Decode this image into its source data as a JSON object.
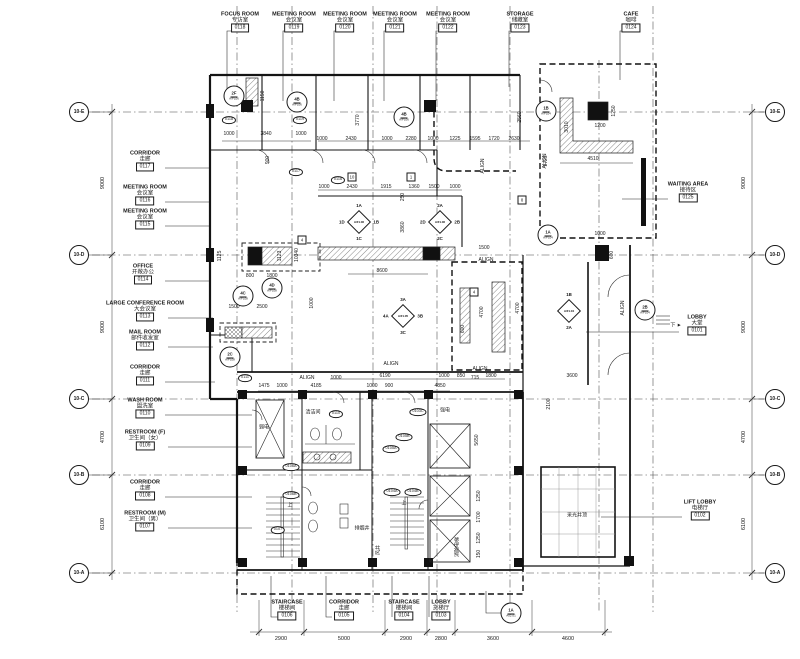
{
  "meta": {
    "background": "#ffffff",
    "ink": "#1a1a1a"
  },
  "rooms": {
    "top": [
      {
        "en": "FOCUS ROOM",
        "cn": "专访室",
        "num": "0118",
        "x": 240,
        "y": 22
      },
      {
        "en": "MEETING ROOM",
        "cn": "会议室",
        "num": "0119",
        "x": 294,
        "y": 22
      },
      {
        "en": "MEETING ROOM",
        "cn": "会议室",
        "num": "0120",
        "x": 345,
        "y": 22
      },
      {
        "en": "MEETING ROOM",
        "cn": "会议室",
        "num": "0121",
        "x": 395,
        "y": 22
      },
      {
        "en": "MEETING ROOM",
        "cn": "会议室",
        "num": "0122",
        "x": 448,
        "y": 22
      },
      {
        "en": "STORAGE",
        "cn": "储藏室",
        "num": "0123",
        "x": 520,
        "y": 22
      },
      {
        "en": "CAFE",
        "cn": "咖啡",
        "num": "0124",
        "x": 631,
        "y": 22
      }
    ],
    "left": [
      {
        "en": "CORRIDOR",
        "cn": "走廊",
        "num": "0117",
        "x": 145,
        "y": 161
      },
      {
        "en": "MEETING ROOM",
        "cn": "会议室",
        "num": "0116",
        "x": 145,
        "y": 195
      },
      {
        "en": "MEETING ROOM",
        "cn": "会议室",
        "num": "0115",
        "x": 145,
        "y": 219
      },
      {
        "en": "OFFICE",
        "cn": "开敞办公",
        "num": "0114",
        "x": 143,
        "y": 274
      },
      {
        "en": "LARGE CONFERENCE ROOM",
        "cn": "大会议室",
        "num": "0113",
        "x": 145,
        "y": 311
      },
      {
        "en": "MAIL ROOM",
        "cn": "邮件收发室",
        "num": "0112",
        "x": 145,
        "y": 340
      },
      {
        "en": "CORRIDOR",
        "cn": "走廊",
        "num": "0111",
        "x": 145,
        "y": 375
      },
      {
        "en": "WASH ROOM",
        "cn": "盥洗室",
        "num": "0110",
        "x": 145,
        "y": 408
      },
      {
        "en": "RESTROOM (F)",
        "cn": "卫生间（女）",
        "num": "0109",
        "x": 145,
        "y": 440
      },
      {
        "en": "CORRIDOR",
        "cn": "走廊",
        "num": "0108",
        "x": 145,
        "y": 490
      },
      {
        "en": "RESTROOM (M)",
        "cn": "卫生间（男）",
        "num": "0107",
        "x": 145,
        "y": 521
      }
    ],
    "right": [
      {
        "en": "WAITING AREA",
        "cn": "接待区",
        "num": "0125",
        "x": 688,
        "y": 192
      },
      {
        "en": "LOBBY",
        "cn": "大堂",
        "num": "0101",
        "x": 697,
        "y": 325
      },
      {
        "en": "LIFT LOBBY",
        "cn": "电梯厅",
        "num": "0102",
        "x": 700,
        "y": 510
      }
    ],
    "bottom": [
      {
        "en": "STAIRCASE",
        "cn": "楼梯间",
        "num": "0106",
        "x": 287,
        "y": 610
      },
      {
        "en": "CORRIDOR",
        "cn": "走廊",
        "num": "0105",
        "x": 344,
        "y": 610
      },
      {
        "en": "STAIRCASE",
        "cn": "楼梯间",
        "num": "0104",
        "x": 404,
        "y": 610
      },
      {
        "en": "LOBBY",
        "cn": "货梯厅",
        "num": "0103",
        "x": 441,
        "y": 610
      }
    ]
  },
  "grid": {
    "left_bubbles": [
      {
        "id": "10-E",
        "x": 79,
        "y": 112
      },
      {
        "id": "10-D",
        "x": 79,
        "y": 255
      },
      {
        "id": "10-C",
        "x": 79,
        "y": 399
      },
      {
        "id": "10-B",
        "x": 79,
        "y": 475
      },
      {
        "id": "10-A",
        "x": 79,
        "y": 573
      }
    ],
    "right_bubbles": [
      {
        "id": "10-E",
        "x": 775,
        "y": 112
      },
      {
        "id": "10-D",
        "x": 775,
        "y": 255
      },
      {
        "id": "10-C",
        "x": 775,
        "y": 399
      },
      {
        "id": "10-B",
        "x": 775,
        "y": 475
      },
      {
        "id": "10-A",
        "x": 775,
        "y": 573
      }
    ],
    "left_dims": [
      {
        "t": "9000",
        "x": 103,
        "y": 183
      },
      {
        "t": "9000",
        "x": 103,
        "y": 327
      },
      {
        "t": "4700",
        "x": 103,
        "y": 437
      },
      {
        "t": "6100",
        "x": 103,
        "y": 524
      }
    ],
    "right_dims": [
      {
        "t": "9000",
        "x": 744,
        "y": 183
      },
      {
        "t": "9000",
        "x": 744,
        "y": 327
      },
      {
        "t": "4700",
        "x": 744,
        "y": 437
      },
      {
        "t": "6100",
        "x": 744,
        "y": 524
      }
    ]
  },
  "bottom_dims": [
    {
      "t": "2900",
      "x": 281
    },
    {
      "t": "5000",
      "x": 344
    },
    {
      "t": "2900",
      "x": 406
    },
    {
      "t": "2800",
      "x": 441
    },
    {
      "t": "3600",
      "x": 493
    },
    {
      "t": "4600",
      "x": 568
    }
  ],
  "annotations": {
    "dims": [
      {
        "t": "1150",
        "x": 263,
        "y": 96,
        "v": 1
      },
      {
        "t": "900",
        "x": 268,
        "y": 160,
        "v": 1
      },
      {
        "t": "3770",
        "x": 358,
        "y": 120,
        "v": 1
      },
      {
        "t": "2560",
        "x": 520,
        "y": 117,
        "v": 1
      },
      {
        "t": "3010",
        "x": 567,
        "y": 127,
        "v": 1
      },
      {
        "t": "1250",
        "x": 614,
        "y": 111,
        "v": 1
      },
      {
        "t": "1725",
        "x": 546,
        "y": 161,
        "v": 1
      },
      {
        "t": "1200",
        "x": 600,
        "y": 126
      },
      {
        "t": "4510",
        "x": 593,
        "y": 159
      },
      {
        "t": "1000",
        "x": 229,
        "y": 134
      },
      {
        "t": "3840",
        "x": 266,
        "y": 134
      },
      {
        "t": "1000",
        "x": 301,
        "y": 134
      },
      {
        "t": "1000",
        "x": 322,
        "y": 139
      },
      {
        "t": "2430",
        "x": 351,
        "y": 139
      },
      {
        "t": "1000",
        "x": 387,
        "y": 139
      },
      {
        "t": "2280",
        "x": 411,
        "y": 139
      },
      {
        "t": "1000",
        "x": 433,
        "y": 139
      },
      {
        "t": "1225",
        "x": 455,
        "y": 139
      },
      {
        "t": "1595",
        "x": 475,
        "y": 139
      },
      {
        "t": "1720",
        "x": 494,
        "y": 139
      },
      {
        "t": "2630",
        "x": 514,
        "y": 139
      },
      {
        "t": "1000",
        "x": 324,
        "y": 187
      },
      {
        "t": "2430",
        "x": 352,
        "y": 187
      },
      {
        "t": "1915",
        "x": 386,
        "y": 187
      },
      {
        "t": "1360",
        "x": 414,
        "y": 187
      },
      {
        "t": "1500",
        "x": 434,
        "y": 187
      },
      {
        "t": "1000",
        "x": 455,
        "y": 187
      },
      {
        "t": "250",
        "x": 403,
        "y": 197,
        "v": 1
      },
      {
        "t": "3860",
        "x": 403,
        "y": 227,
        "v": 1
      },
      {
        "t": "1500",
        "x": 484,
        "y": 248
      },
      {
        "t": "1125",
        "x": 220,
        "y": 256,
        "v": 1
      },
      {
        "t": "1123",
        "x": 280,
        "y": 256,
        "v": 1
      },
      {
        "t": "10340",
        "x": 297,
        "y": 255,
        "v": 1
      },
      {
        "t": "800",
        "x": 250,
        "y": 276
      },
      {
        "t": "1800",
        "x": 272,
        "y": 276
      },
      {
        "t": "1500",
        "x": 234,
        "y": 307
      },
      {
        "t": "2500",
        "x": 262,
        "y": 307
      },
      {
        "t": "1000",
        "x": 312,
        "y": 303,
        "v": 1
      },
      {
        "t": "8600",
        "x": 382,
        "y": 271
      },
      {
        "t": "4700",
        "x": 482,
        "y": 312,
        "v": 1
      },
      {
        "t": "4700",
        "x": 518,
        "y": 308,
        "v": 1
      },
      {
        "t": "600",
        "x": 463,
        "y": 329,
        "v": 1
      },
      {
        "t": "1000",
        "x": 336,
        "y": 378
      },
      {
        "t": "6190",
        "x": 385,
        "y": 376
      },
      {
        "t": "1000",
        "x": 444,
        "y": 376
      },
      {
        "t": "850",
        "x": 461,
        "y": 376
      },
      {
        "t": "715",
        "x": 475,
        "y": 378
      },
      {
        "t": "1800",
        "x": 491,
        "y": 376
      },
      {
        "t": "3600",
        "x": 572,
        "y": 376
      },
      {
        "t": "2100",
        "x": 549,
        "y": 404,
        "v": 1
      },
      {
        "t": "1000",
        "x": 600,
        "y": 234
      },
      {
        "t": "600",
        "x": 612,
        "y": 255,
        "v": 1
      },
      {
        "t": "1475",
        "x": 264,
        "y": 386
      },
      {
        "t": "1000",
        "x": 282,
        "y": 386
      },
      {
        "t": "4185",
        "x": 316,
        "y": 386
      },
      {
        "t": "1000",
        "x": 372,
        "y": 386
      },
      {
        "t": "900",
        "x": 389,
        "y": 386
      },
      {
        "t": "4850",
        "x": 440,
        "y": 386
      },
      {
        "t": "5650",
        "x": 477,
        "y": 440,
        "v": 1
      },
      {
        "t": "1250",
        "x": 479,
        "y": 496,
        "v": 1
      },
      {
        "t": "1700",
        "x": 479,
        "y": 517,
        "v": 1
      },
      {
        "t": "1250",
        "x": 479,
        "y": 538,
        "v": 1
      },
      {
        "t": "150",
        "x": 479,
        "y": 554,
        "v": 1
      }
    ],
    "texts": [
      {
        "t": "ALIGN",
        "x": 307,
        "y": 378
      },
      {
        "t": "ALIGN",
        "x": 391,
        "y": 364
      },
      {
        "t": "ALIGN",
        "x": 480,
        "y": 369
      },
      {
        "t": "ALIGN",
        "x": 486,
        "y": 260
      },
      {
        "t": "ALIGN",
        "x": 483,
        "y": 166,
        "v": 1
      },
      {
        "t": "ALIGN",
        "x": 545,
        "y": 161,
        "v": 1
      },
      {
        "t": "ALIGN",
        "x": 623,
        "y": 308,
        "v": 1
      },
      {
        "t": "下 ►",
        "x": 676,
        "y": 325
      },
      {
        "t": "风井",
        "x": 378,
        "y": 550,
        "v": 1
      },
      {
        "t": "排烟井",
        "x": 362,
        "y": 528
      },
      {
        "t": "消防电梯",
        "x": 457,
        "y": 547,
        "v": 1
      },
      {
        "t": "采光井顶",
        "x": 577,
        "y": 515
      },
      {
        "t": "强电",
        "x": 445,
        "y": 410
      },
      {
        "t": "弱电",
        "x": 264,
        "y": 427
      },
      {
        "t": "清洁间",
        "x": 313,
        "y": 412
      },
      {
        "t": "上",
        "x": 290,
        "y": 505
      },
      {
        "t": "上",
        "x": 404,
        "y": 503
      }
    ],
    "tags": [
      {
        "t": "0118",
        "x": 229,
        "y": 120
      },
      {
        "t": "0119",
        "x": 300,
        "y": 120
      },
      {
        "t": "0117",
        "x": 296,
        "y": 172
      },
      {
        "t": "0116",
        "x": 338,
        "y": 180
      },
      {
        "t": "0111",
        "x": 245,
        "y": 378
      },
      {
        "t": "0110",
        "x": 336,
        "y": 414
      },
      {
        "t": "0103C",
        "x": 418,
        "y": 412
      },
      {
        "t": "0105B",
        "x": 404,
        "y": 437
      },
      {
        "t": "0105A",
        "x": 391,
        "y": 449
      },
      {
        "t": "0104A",
        "x": 392,
        "y": 492
      },
      {
        "t": "0104B",
        "x": 413,
        "y": 492
      },
      {
        "t": "0106A",
        "x": 291,
        "y": 467
      },
      {
        "t": "0106B",
        "x": 291,
        "y": 495
      },
      {
        "t": "0107",
        "x": 278,
        "y": 530
      }
    ],
    "keynotes": [
      {
        "t": "1",
        "x": 411,
        "y": 177
      },
      {
        "t": "10",
        "x": 352,
        "y": 177
      },
      {
        "t": "4",
        "x": 302,
        "y": 240
      },
      {
        "t": "4",
        "x": 474,
        "y": 292
      },
      {
        "t": "8",
        "x": 522,
        "y": 200
      }
    ],
    "diamonds": [
      {
        "x": 359,
        "y": 222,
        "top": "1A",
        "left": "1D",
        "right": "1B",
        "bottom": "1C",
        "code": "A/FL06"
      },
      {
        "x": 440,
        "y": 222,
        "top": "2A",
        "left": "2D",
        "right": "2B",
        "bottom": "2C",
        "code": "A/FL06"
      },
      {
        "x": 403,
        "y": 316,
        "top": "3A",
        "left": "4A",
        "right": "3B",
        "bottom": "3C",
        "code": "A/FL05"
      },
      {
        "x": 569,
        "y": 311,
        "top": "1B",
        "bottom": "2A",
        "code": "A/FL04"
      }
    ],
    "circles": [
      {
        "t": "2F",
        "c": "A/FL06",
        "x": 234,
        "y": 96
      },
      {
        "t": "4B",
        "c": "A/FL06",
        "x": 297,
        "y": 102
      },
      {
        "t": "4B",
        "c": "A/FL06",
        "x": 404,
        "y": 117
      },
      {
        "t": "1B",
        "c": "A/FL04",
        "x": 546,
        "y": 111
      },
      {
        "t": "1A",
        "c": "A/FL04",
        "x": 548,
        "y": 235
      },
      {
        "t": "2B",
        "c": "A/FL04",
        "x": 645,
        "y": 310
      },
      {
        "t": "4C",
        "c": "A/FL08",
        "x": 243,
        "y": 296
      },
      {
        "t": "4D",
        "c": "A/FL08",
        "x": 272,
        "y": 288
      },
      {
        "t": "2C",
        "c": "A/FL08",
        "x": 230,
        "y": 357
      },
      {
        "t": "1A",
        "c": "A02.01",
        "x": 511,
        "y": 613
      }
    ]
  }
}
